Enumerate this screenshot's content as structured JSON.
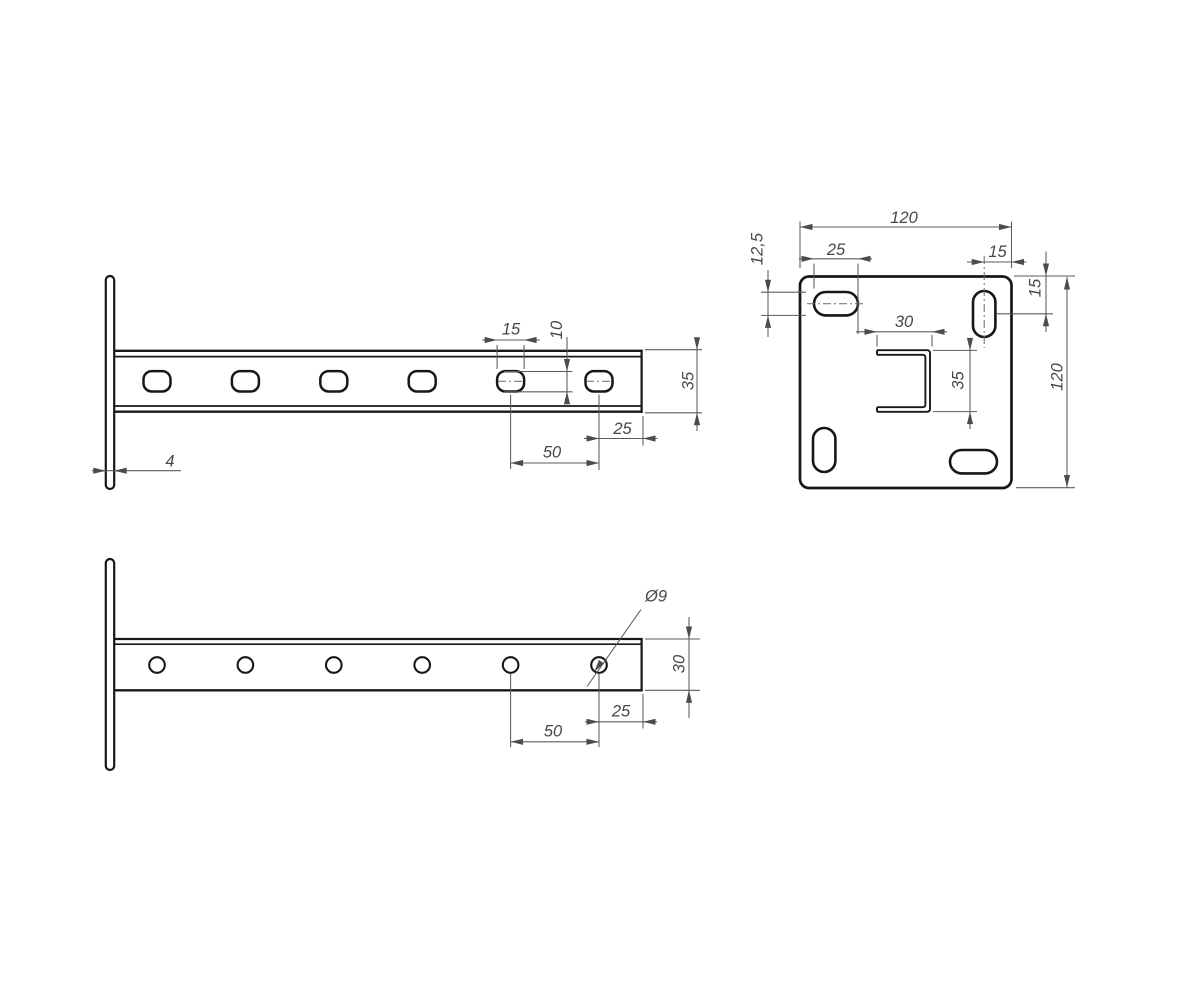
{
  "drawing": {
    "background_color": "#ffffff",
    "outline_color": "#171717",
    "dimension_color": "#5b5b5b",
    "text_color": "#474747",
    "dims": {
      "side": {
        "slot_length": "15",
        "slot_width": "10",
        "channel_height": "35",
        "end_offset": "25",
        "hole_pitch": "50",
        "plate_thickness": "4"
      },
      "plate": {
        "width": "120",
        "height": "120",
        "slot_length": "25",
        "slot_width": "12,5",
        "slot_center_to_edge": "15",
        "slot_center_from_top": "15",
        "channel_width": "30",
        "channel_height": "35"
      },
      "bottom": {
        "hole_diameter": "Ø9",
        "channel_width": "30",
        "end_offset": "25",
        "hole_pitch": "50"
      }
    }
  }
}
